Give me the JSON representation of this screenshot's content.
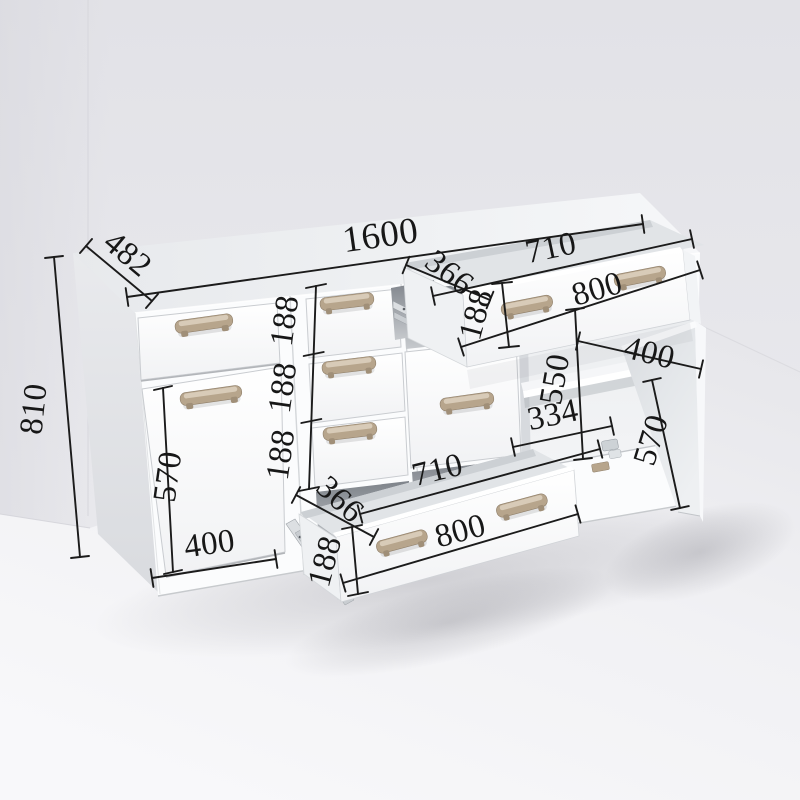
{
  "dimensions": {
    "overall": {
      "width": "1600",
      "depth": "482",
      "height": "810"
    },
    "left_section": {
      "drawer_height": "188",
      "door_height": "570",
      "door_width": "400"
    },
    "middle_drawers": {
      "drawer1_height": "188",
      "drawer2_height": "188",
      "drawer3_height": "188"
    },
    "top_open_drawer": {
      "side_depth": "366",
      "inner_width": "710",
      "front_width": "800",
      "front_height": "188"
    },
    "right_section": {
      "opening_height": "550",
      "shelf_depth": "334",
      "door_width": "400",
      "door_height": "570"
    },
    "bottom_open_drawer": {
      "side_depth": "366",
      "inner_width": "710",
      "front_width": "800",
      "front_height": "188"
    }
  },
  "colors": {
    "dimension_line": "#1b1b1b",
    "dimension_text": "#171717",
    "cabinet_front": "#fbfcfd",
    "handle": "#b7a58c",
    "handle_highlight": "#dccfbd",
    "handle_dark": "#9c8b74",
    "wall": "#e8e8ec",
    "floor": "#f6f6f8"
  }
}
